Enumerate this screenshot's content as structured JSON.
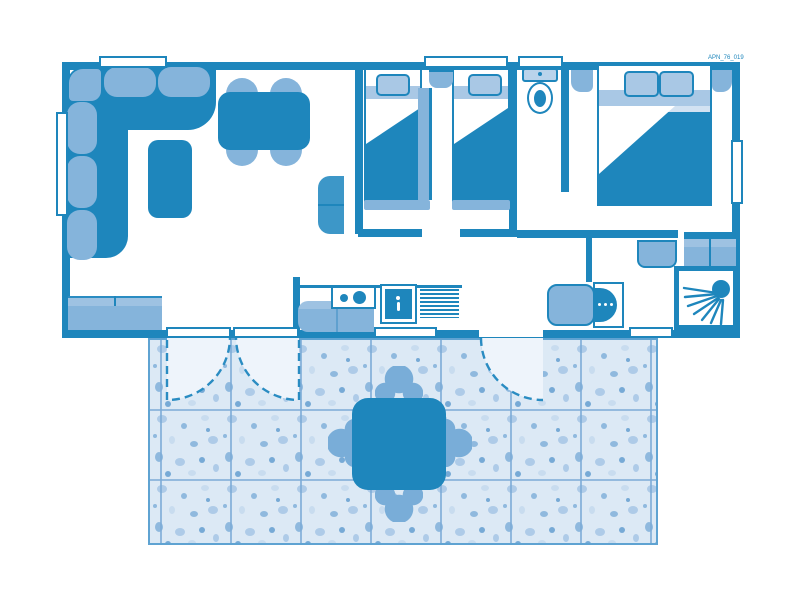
{
  "plan": {
    "label": "APN_76_019"
  },
  "colors": {
    "wall": "#1e86bc",
    "furniture_light": "#85b4db",
    "sheet_band": "#a9c8e5",
    "pale": "#d2e2f2",
    "tile": "#dce9f5",
    "tile_line": "#7cabd7",
    "door_arc": "#2a8cc2",
    "terrace_chair": "#79add8",
    "white": "#ffffff"
  },
  "fixtures": [
    "corner-sofa",
    "coffee-table",
    "dining-table",
    "sideboard",
    "wardrobe",
    "kitchen-counter",
    "hob",
    "sink",
    "drainer",
    "single-bed",
    "single-bed",
    "double-bed",
    "nightstands",
    "toilet",
    "washbasin",
    "shower",
    "wardrobes",
    "terrace",
    "terrace-table",
    "terrace-chairs",
    "door-swing-arcs"
  ]
}
